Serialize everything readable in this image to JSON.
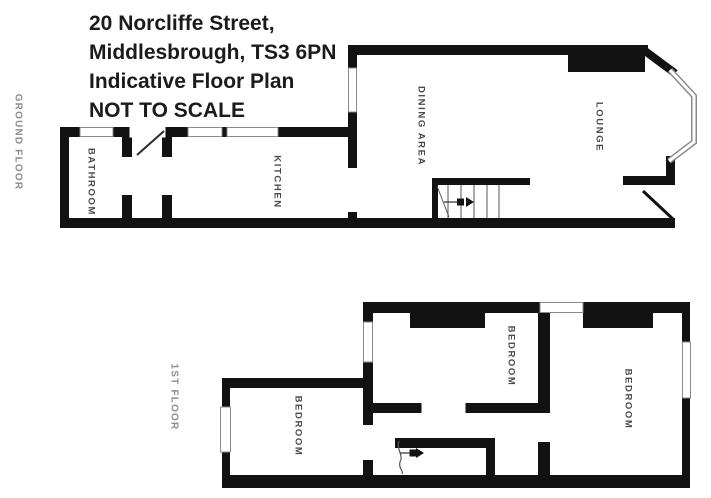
{
  "title": {
    "lines": [
      "20 Norcliffe Street,",
      "Middlesbrough, TS3 6PN",
      "Indicative Floor Plan",
      "NOT TO SCALE"
    ]
  },
  "floors": [
    {
      "label": "GROUND FLOOR",
      "rooms": [
        "BATHROOM",
        "KITCHEN",
        "DINING AREA",
        "LOUNGE"
      ]
    },
    {
      "label": "1ST FLOOR",
      "rooms": [
        "BEDROOM",
        "BEDROOM",
        "BEDROOM"
      ]
    }
  ],
  "colors": {
    "background": "#ffffff",
    "wall": "#121212",
    "title_text": "#1b1b1b",
    "room_label": "#4a4a4a",
    "floor_label": "#8e8e8e",
    "window_line": "#8a8a8a",
    "stair_line": "#555555"
  }
}
